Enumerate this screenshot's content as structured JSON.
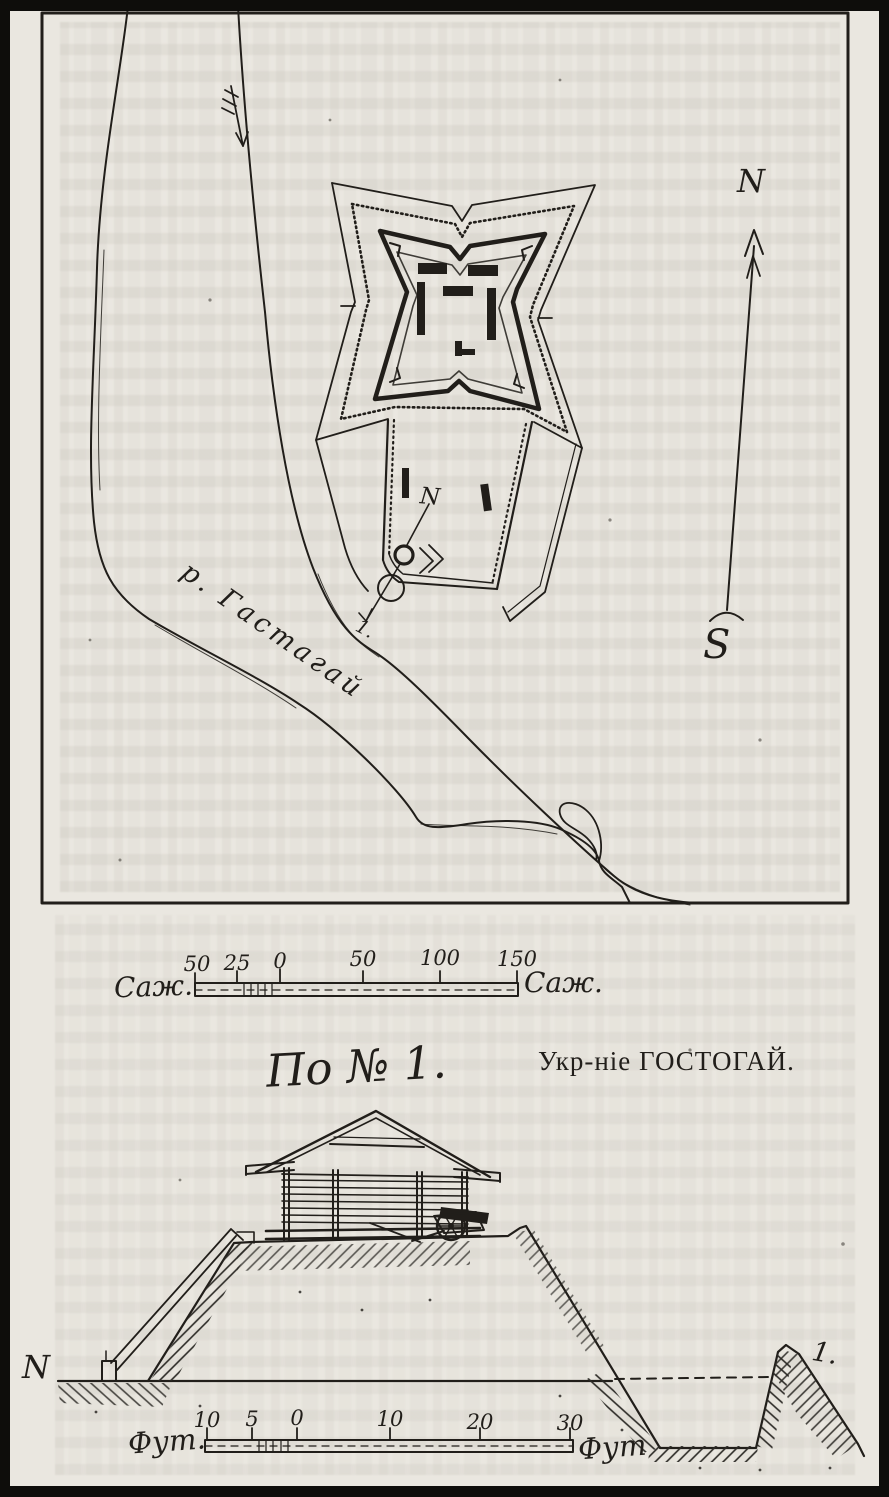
{
  "map": {
    "compass": {
      "north": "N",
      "south": "S"
    },
    "river_label": "р. Гастагай",
    "section_line": {
      "start": "N",
      "end": "1."
    },
    "scale": {
      "unit_left": "Саж.",
      "unit_right": "Саж.",
      "ticks": [
        "50",
        "25",
        "0",
        "50",
        "100",
        "150"
      ]
    }
  },
  "profile": {
    "title": "По № 1.",
    "caption": "Укр-ніе ГОСТОГАЙ.",
    "left_marker": "N",
    "right_marker": "1.",
    "scale": {
      "unit_left": "Фут.",
      "unit_right": "Фут",
      "ticks": [
        "10",
        "5",
        "0",
        "10",
        "20",
        "30"
      ]
    }
  },
  "colors": {
    "paper": "#eae7e0",
    "ink": "#211e1a"
  }
}
